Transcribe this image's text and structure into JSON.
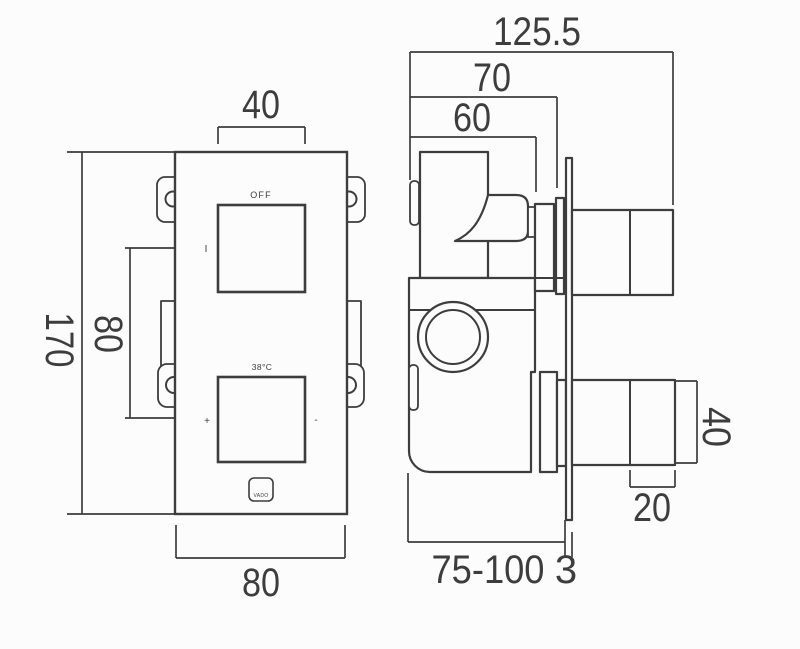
{
  "colors": {
    "background": "#fcfcfc",
    "line": "#3d3d3d",
    "text": "#3d3d3d"
  },
  "front_view": {
    "dim_top_width": "40",
    "dim_overall_height": "170",
    "dim_handle_centres": "80",
    "dim_bottom_width": "80",
    "label_off": "OFF",
    "label_on_mark": "I",
    "label_temperature": "38°C",
    "label_plus": "+",
    "label_minus": "-",
    "logo_text": "VADO"
  },
  "side_view": {
    "dim_overall_depth": "125.5",
    "dim_depth_to_stem": "70",
    "dim_depth_to_handle": "60",
    "dim_knob_height": "40",
    "dim_knob_depth": "20",
    "dim_installation_depth_range": "75-100",
    "dim_plate_thickness": "3"
  }
}
